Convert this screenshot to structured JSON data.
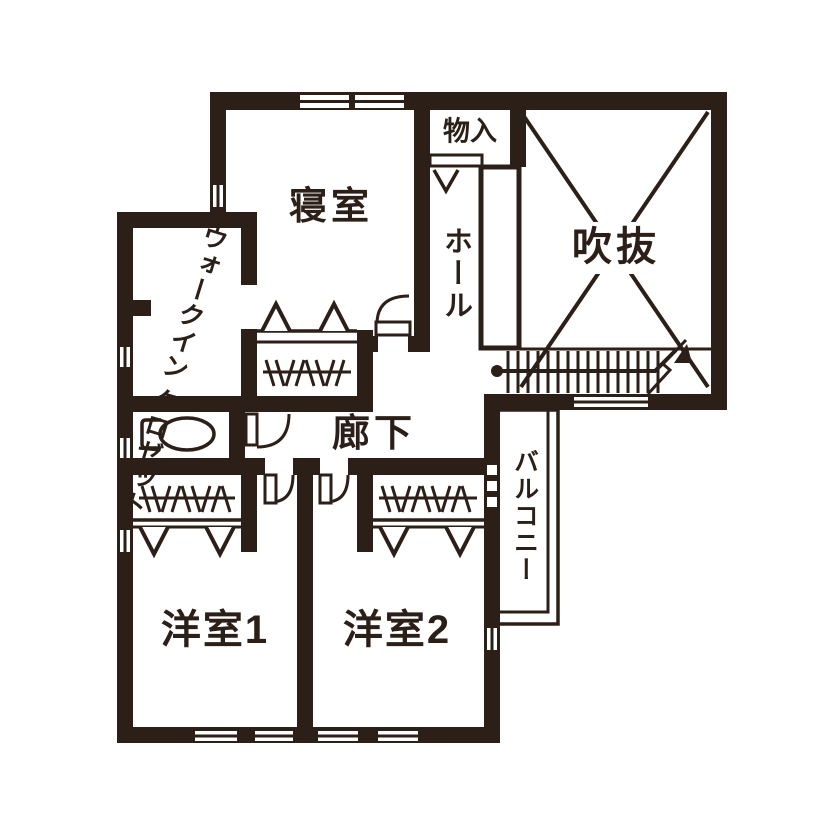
{
  "title": "2階 間取り図",
  "colors": {
    "ink": "#2b1f18",
    "bg": "#ffffff"
  },
  "labels": {
    "bedroom": "寝室",
    "storage": "物入",
    "hall": "ホール",
    "void": "吹抜",
    "corridor": "廊下",
    "balcony": "バルコニー",
    "wic_line1": "ウォークイン",
    "wic_line2": "クロゼット",
    "room1": "洋室1",
    "room2": "洋室2"
  },
  "icons": {
    "toilet": "toilet-icon",
    "stairs": "staircase-icon",
    "void_cross": "x-cross-icon",
    "up_arrow": "stair-direction-arrow-icon"
  }
}
